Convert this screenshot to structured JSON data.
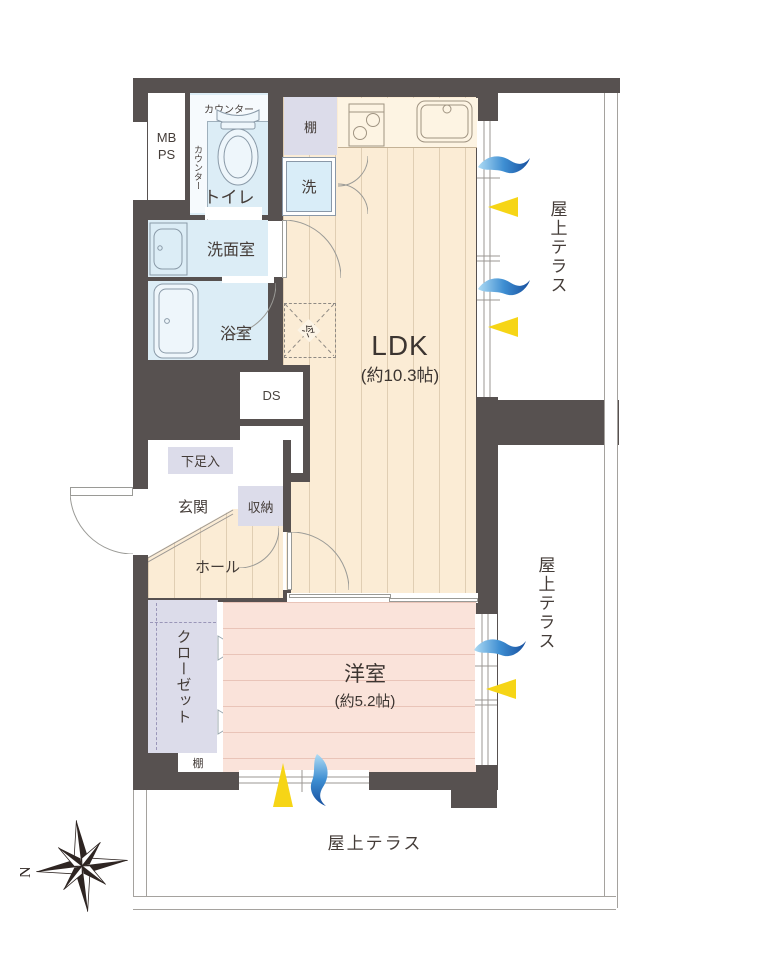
{
  "title": "apartment floor plan",
  "colors": {
    "wall": "#575150",
    "ldk_floor": "#fbecd5",
    "western_floor": "#fae3da",
    "wet_rooms": "#dcedf6",
    "cabinets": "#dcdcea",
    "terrace_line": "#a5a29e",
    "wind_icon_blue": "#174f9e",
    "daylight_icon_yellow": "#f6d516",
    "text": "#443c38"
  },
  "rooms": {
    "mb_ps": {
      "label": "MB PS"
    },
    "toilet": {
      "label": "トイレ",
      "counter_top": "カウンター",
      "counter_side": "カウンター"
    },
    "washroom": {
      "label": "洗面室"
    },
    "bathroom": {
      "label": "浴室"
    },
    "shelf_top": {
      "label": "棚"
    },
    "laundry": {
      "label": "洗"
    },
    "ldk": {
      "label": "LDK",
      "size": "(約10.3帖)"
    },
    "refrigerator": {
      "label": "冷"
    },
    "duct_space_1": {
      "label": "DS"
    },
    "duct_space_2": {
      "label": "DS"
    },
    "shoe_cabinet": {
      "label": "下足入"
    },
    "entrance": {
      "label": "玄関"
    },
    "storage": {
      "label": "収納"
    },
    "hall": {
      "label": "ホール"
    },
    "closet": {
      "label": "クローゼット",
      "shelf": "棚"
    },
    "western_room": {
      "label": "洋室",
      "size": "(約5.2帖)"
    },
    "terrace_top_right": {
      "label": "屋上テラス"
    },
    "terrace_right": {
      "label": "屋上テラス"
    },
    "terrace_bottom": {
      "label": "屋上テラス"
    }
  },
  "icons": {
    "wind": "blue-wave",
    "daylight": "yellow-beam",
    "compass": "eight-point-star"
  },
  "compass": {
    "label": "N"
  }
}
